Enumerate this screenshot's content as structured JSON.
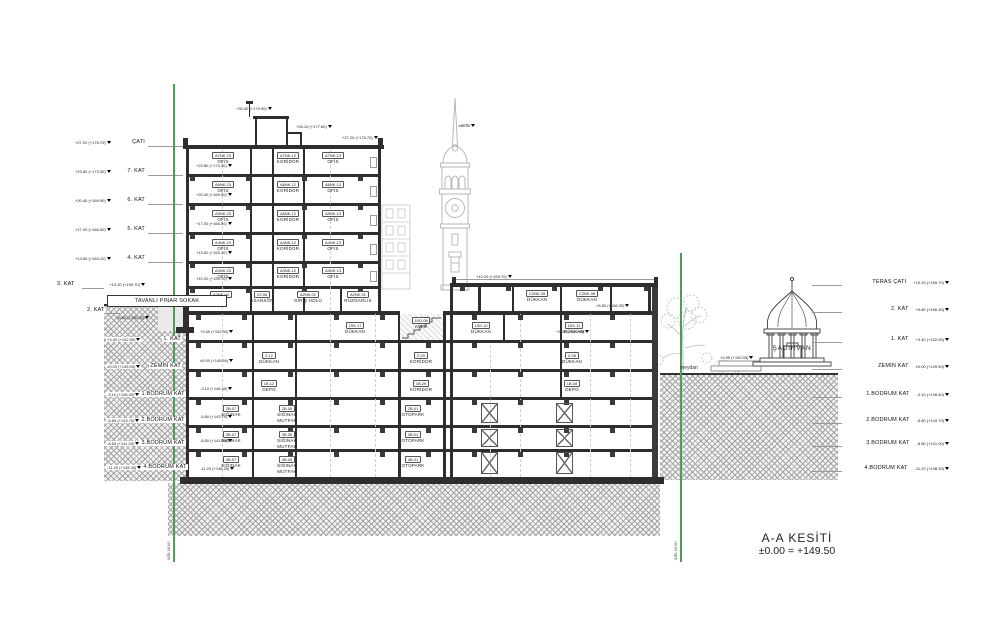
{
  "title": {
    "name": "A-A KESİTİ",
    "datum": "±0.00 = +149.50"
  },
  "labels": {
    "street": "TAVANLI PINAR SOKAK",
    "square": "meydan",
    "boundary": "ada sınırı",
    "fountain": "ŞADIRVAN"
  },
  "levels_left": [
    {
      "label": "ÇATI",
      "elev": "+27.20 (+176.70)"
    },
    {
      "label": "7. KAT",
      "elev": "+23.80 (+173.30)"
    },
    {
      "label": "6. KAT",
      "elev": "+20.40 (+169.90)"
    },
    {
      "label": "5. KAT",
      "elev": "+17.00 (+166.50)"
    },
    {
      "label": "4. KAT",
      "elev": "+13.60 (+163.10)"
    },
    {
      "label": "3. KAT",
      "elev": "+10.20 (+159.70)"
    },
    {
      "label": "2. KAT",
      "elev": "+6.80 (+156.30)"
    },
    {
      "label": "1. KAT",
      "elev": "+3.40 (+152.90)"
    },
    {
      "label": "ZEMİN KAT",
      "elev": "±0.00 (+149.50)"
    },
    {
      "label": "1.BODRUM KAT",
      "elev": "-3.10 (+146.40)"
    },
    {
      "label": "2.BODRUM KAT",
      "elev": "-5.80 (+143.70)"
    },
    {
      "label": "3.BODRUM KAT",
      "elev": "-8.50 (+141.00)"
    },
    {
      "label": "4.BODRUM KAT",
      "elev": "-11.20 (+138.30)"
    }
  ],
  "levels_right": [
    {
      "label": "TERAS ÇATI",
      "elev": "+10.20 (+159.70)"
    },
    {
      "label": "2. KAT",
      "elev": "+6.80 (+156.30)"
    },
    {
      "label": "1. KAT",
      "elev": "+3.40 (+152.90)"
    },
    {
      "label": "ZEMİN KAT",
      "elev": "±0.00 (+149.50)"
    },
    {
      "label": "1.BODRUM KAT",
      "elev": "-3.10 (+146.40)"
    },
    {
      "label": "2.BODRUM KAT",
      "elev": "-5.80 (+143.70)"
    },
    {
      "label": "3.BODRUM KAT",
      "elev": "-8.50 (+141.00)"
    },
    {
      "label": "4.BODRUM KAT",
      "elev": "-11.20 (+138.30)"
    }
  ],
  "rooms": [
    {
      "code": "A7NK.23",
      "name": "OFİS"
    },
    {
      "code": "A7NK.12",
      "name": "KORİDOR"
    },
    {
      "code": "A7NK.13",
      "name": "OFİS"
    },
    {
      "code": "A6NK.23",
      "name": "OFİS"
    },
    {
      "code": "A6NK.12",
      "name": "KORİDOR"
    },
    {
      "code": "A6NK.13",
      "name": "OFİS"
    },
    {
      "code": "A5NK.23",
      "name": "OFİS"
    },
    {
      "code": "A5NK.12",
      "name": "KORİDOR"
    },
    {
      "code": "A5NK.13",
      "name": "OFİS"
    },
    {
      "code": "A4NK.23",
      "name": "OFİS"
    },
    {
      "code": "A4NK.12",
      "name": "KORİDOR"
    },
    {
      "code": "A4NK.13",
      "name": "OFİS"
    },
    {
      "code": "A3NK.23",
      "name": "OFİS"
    },
    {
      "code": "A3NK.12",
      "name": "KORİDOR"
    },
    {
      "code": "A3NK.13",
      "name": "OFİS"
    },
    {
      "code": "A2NK.04",
      "name": "OFİS"
    },
    {
      "code": "X3.06",
      "name": "ASANSÖR"
    },
    {
      "code": "A2NK.02",
      "name": "GİRİŞ HOLÜ"
    },
    {
      "code": "A2NK.01",
      "name": "RÜZGARLIK"
    },
    {
      "code": "1SK.17",
      "name": "DÜKKAN"
    },
    {
      "code": "1SO.06",
      "name": "AVLU"
    },
    {
      "code": "1SK.10",
      "name": "DÜKKAN"
    },
    {
      "code": "1SK.11",
      "name": "DÜKKAN"
    },
    {
      "code": "Z.12",
      "name": "DÜKKAN"
    },
    {
      "code": "Z.29",
      "name": "KORİDOR"
    },
    {
      "code": "Z.08",
      "name": "DÜKKAN"
    },
    {
      "code": "1B.12",
      "name": "DEPO"
    },
    {
      "code": "1B.29",
      "name": "KORİDOR"
    },
    {
      "code": "1B.08",
      "name": "DEPO"
    },
    {
      "code": "2B.07",
      "name": "SIĞINAK"
    },
    {
      "code": "2B.06",
      "name": "SIĞINAK MUTFAK"
    },
    {
      "code": "2B.01",
      "name": "OTOPARK"
    },
    {
      "code": "3B.07",
      "name": "SIĞINAK"
    },
    {
      "code": "3B.06",
      "name": "SIĞINAK MUTFAK"
    },
    {
      "code": "3B.01",
      "name": "OTOPARK"
    },
    {
      "code": "4B.07",
      "name": "SIĞINAK"
    },
    {
      "code": "4B.06",
      "name": "SIĞINAK MUTFAK"
    },
    {
      "code": "4B.01",
      "name": "OTOPARK"
    },
    {
      "code": "C2NK.05",
      "name": "DÜKKAN"
    },
    {
      "code": "C2NK.06",
      "name": "DÜKKAN"
    }
  ],
  "marks": [
    "+30.40 (+179.90)",
    "+28.10 (+177.60)",
    "+27.20 (+176.70)",
    "+23.80 (+173.30)",
    "+20.40 (+169.90)",
    "+17.00 (+166.50)",
    "+13.60 (+163.10)",
    "+10.20 (+159.70)",
    "+3.40 (+152.90)",
    "±0.00 (+149.50)",
    "-3.10 (+146.40)",
    "-5.80 (+143.70)",
    "-8.50 (+141.00)",
    "-11.20 (+138.30)",
    "+10.20 (+159.70)",
    "+6.80 (+156.30)",
    "+3.40 (+152.90)",
    "+45.50",
    "+0.55 (+150.05)",
    "+6.80 (+156.30)"
  ]
}
